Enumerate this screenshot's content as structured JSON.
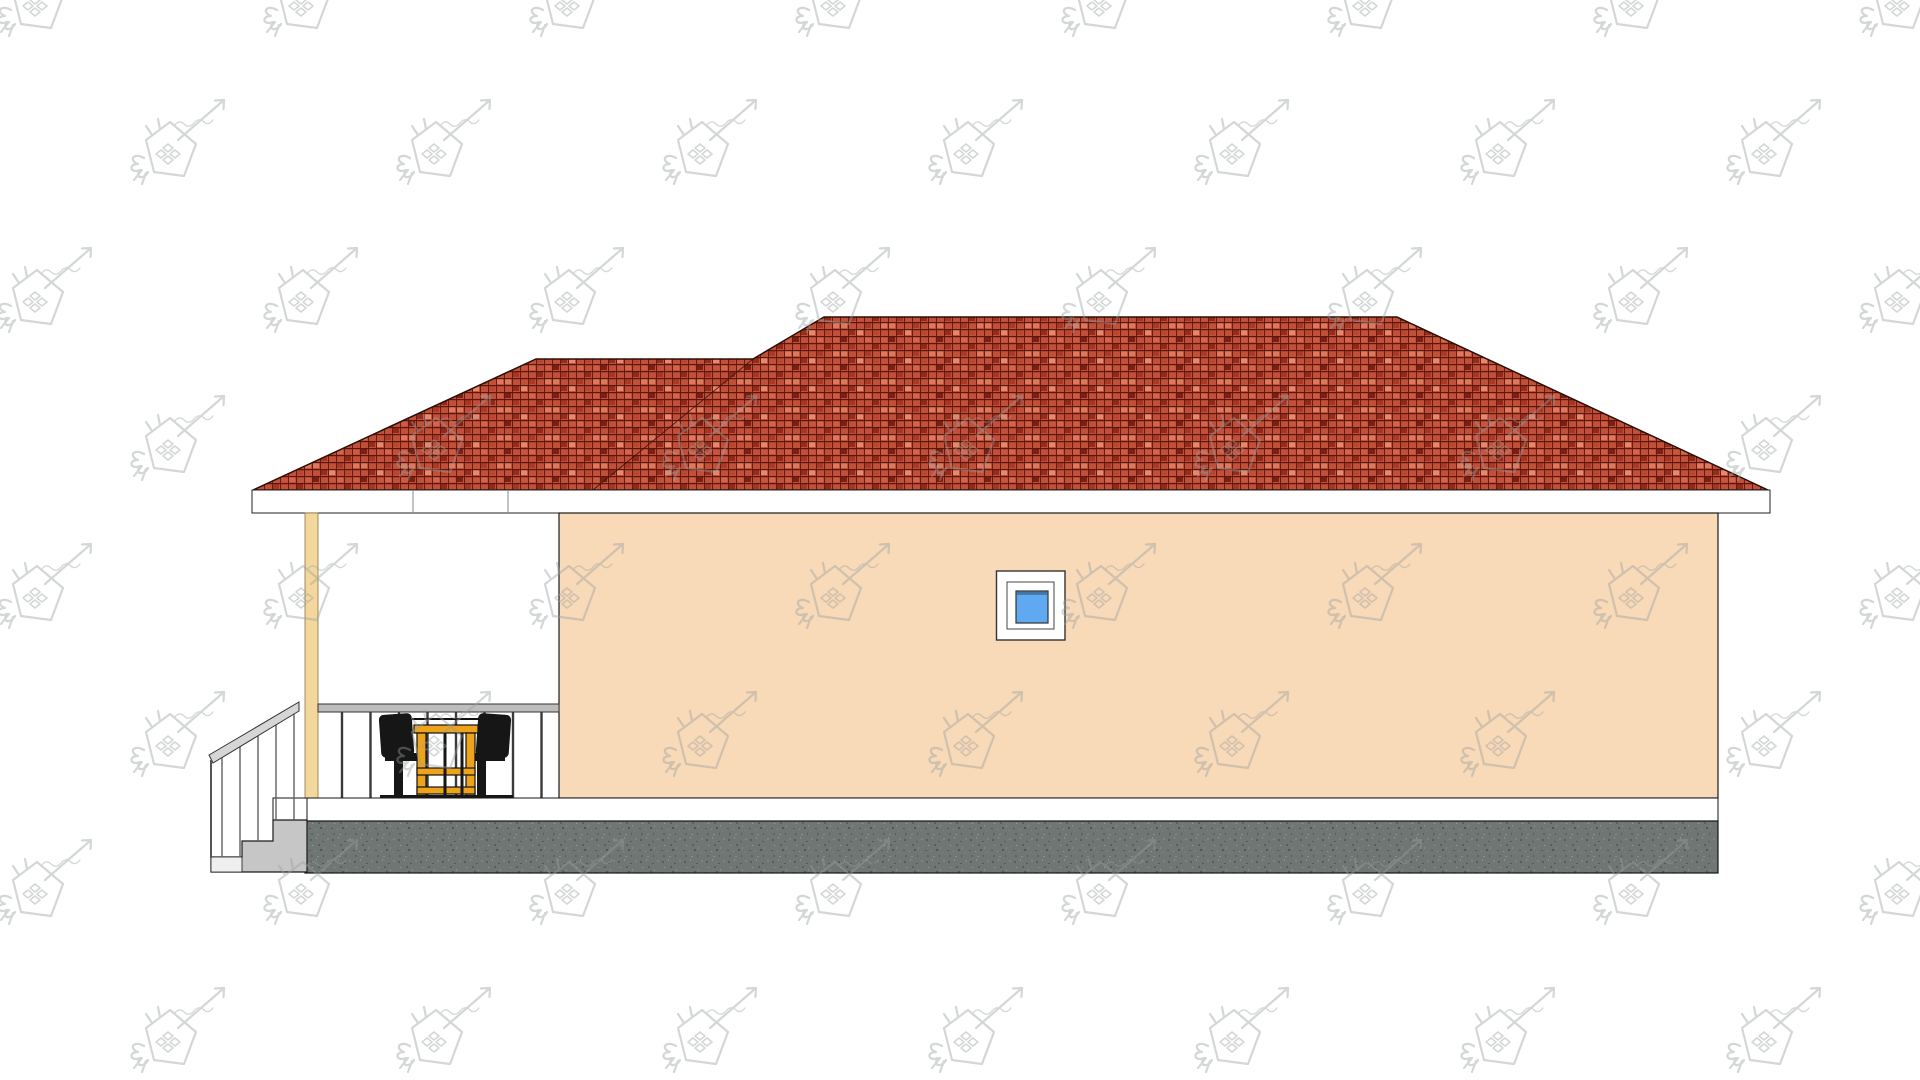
{
  "drawing": {
    "kind": "house-side-elevation",
    "visible_text": ""
  },
  "colors": {
    "background": "#ffffff",
    "roof_base": "#c0503a",
    "roof_grid_dark": "#5c170c",
    "roof_joint_dark": "#6b1b0e",
    "fascia": "#ffffff",
    "wall": "#f8d9b8",
    "outline": "#1a1a1a",
    "window_frame": "#ffffff",
    "window_glass": "#5fa9f0",
    "window_glass_shadow": "#2b4a66",
    "post": "#f3d79d",
    "rail": "#bdbdbd",
    "baluster": "#3a3a3a",
    "floor": "#ffffff",
    "foundation": "#6f7674",
    "stairs": "#c6c6c6",
    "stair_rail": "#d6d6d6",
    "table": "#eda31b",
    "chair": "#161616",
    "watermark": "#9aa0a0"
  },
  "porch_railing": {
    "count": 8,
    "x_start": 342,
    "spacing": 28.5,
    "y_top": 712,
    "y_bottom": 798
  },
  "watermark": {
    "rows": 8,
    "cols": 8,
    "x0": -25,
    "y0": -38,
    "dx": 266,
    "dy": 148,
    "row_offset": 133,
    "opacity": 0.42
  }
}
